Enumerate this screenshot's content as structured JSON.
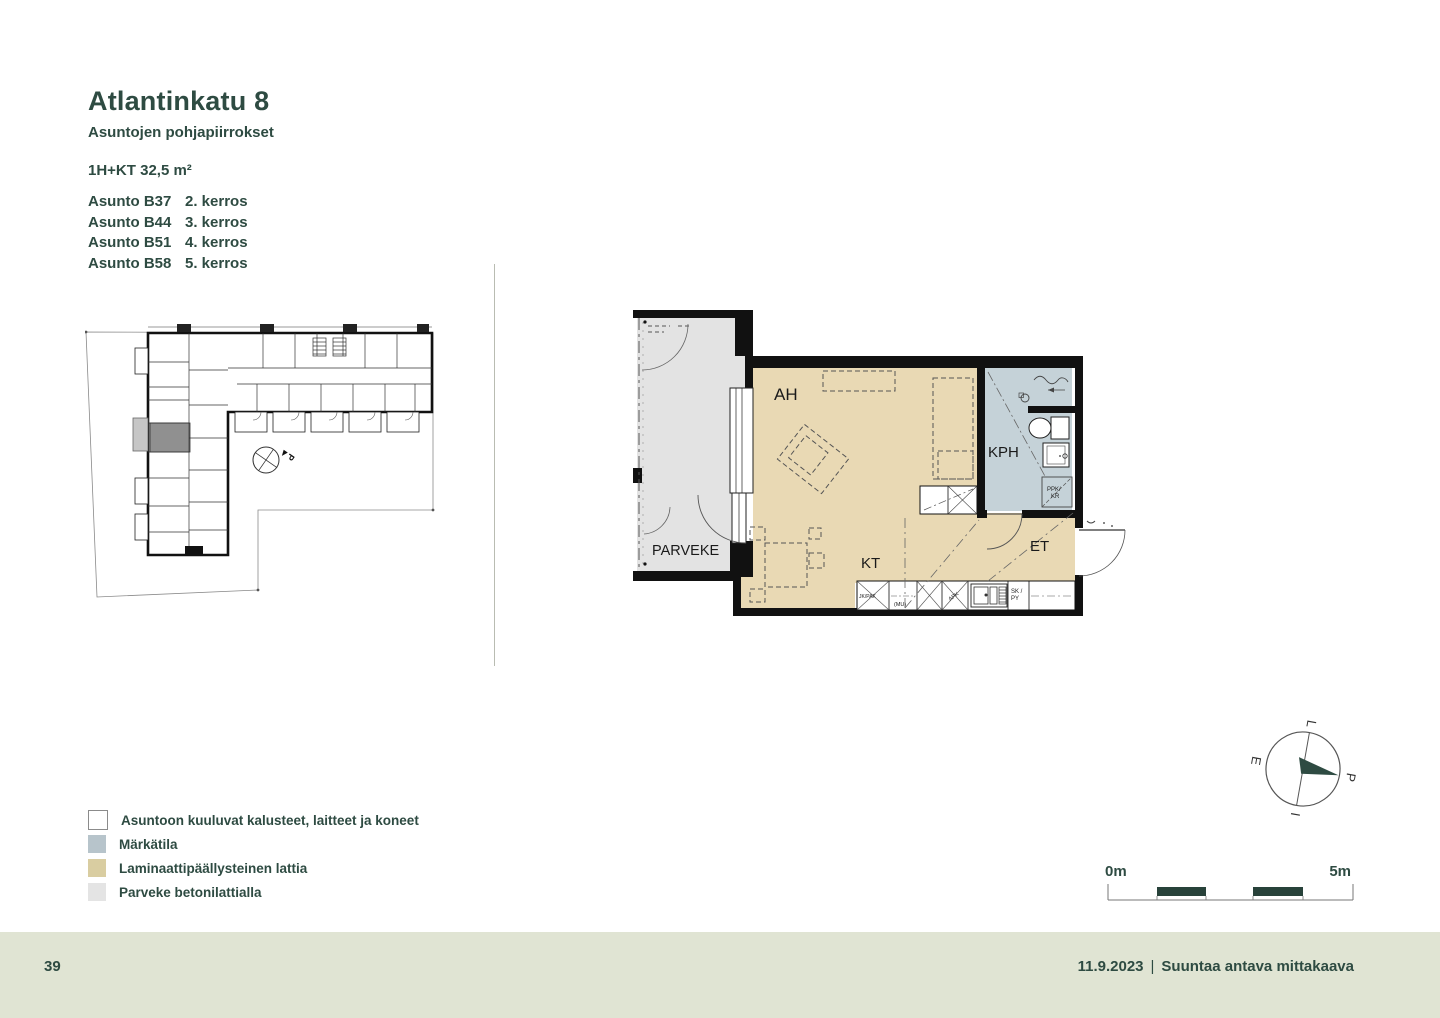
{
  "header": {
    "title": "Atlantinkatu 8",
    "subtitle": "Asuntojen pohjapiirrokset",
    "unit_type": "1H+KT 32,5 m²",
    "apartments": [
      {
        "name": "Asunto B37",
        "floor": "2. kerros"
      },
      {
        "name": "Asunto B44",
        "floor": "3. kerros"
      },
      {
        "name": "Asunto B51",
        "floor": "4. kerros"
      },
      {
        "name": "Asunto B58",
        "floor": "5. kerros"
      }
    ]
  },
  "site_plan": {
    "north_marker": "P"
  },
  "floor_plan": {
    "labels": {
      "living_room": "AH",
      "kitchen": "KT",
      "bathroom": "KPH",
      "entry": "ET",
      "balcony": "PARVEKE"
    },
    "small_labels": {
      "fridge_freezer": "JK/PAK",
      "reservation_mu": "(MU)",
      "dishwasher": "APK",
      "cleaning_cabinet_line1": "SK /",
      "cleaning_cabinet_line2": "PY",
      "washer_line1": "PPK/",
      "washer_line2": "KR"
    }
  },
  "legend": {
    "items": [
      {
        "label": "Asuntoon kuuluvat kalusteet, laitteet ja koneet",
        "color": "#ffffff"
      },
      {
        "label": "Märkätila",
        "color": "#b7c4cb"
      },
      {
        "label": "Laminaattipäällysteinen lattia",
        "color": "#d9cda1"
      },
      {
        "label": "Parveke betonilattialla",
        "color": "#e4e4e4"
      }
    ]
  },
  "scale_bar": {
    "start": "0m",
    "end": "5m"
  },
  "compass": {
    "north": "P",
    "east": "I",
    "south": "E",
    "west": "L"
  },
  "footer": {
    "page_number": "39",
    "date": "11.9.2023",
    "separator": "|",
    "note": "Suuntaa antava mittakaava"
  },
  "colors": {
    "accent_green": "#2e4b42",
    "footer_bg": "#e0e4d3",
    "laminate_floor": "#e9d9b4",
    "wet_room_floor": "#c5d2d8",
    "balcony_floor": "#e3e3e3",
    "highlight_unit_gray": "#909090"
  }
}
